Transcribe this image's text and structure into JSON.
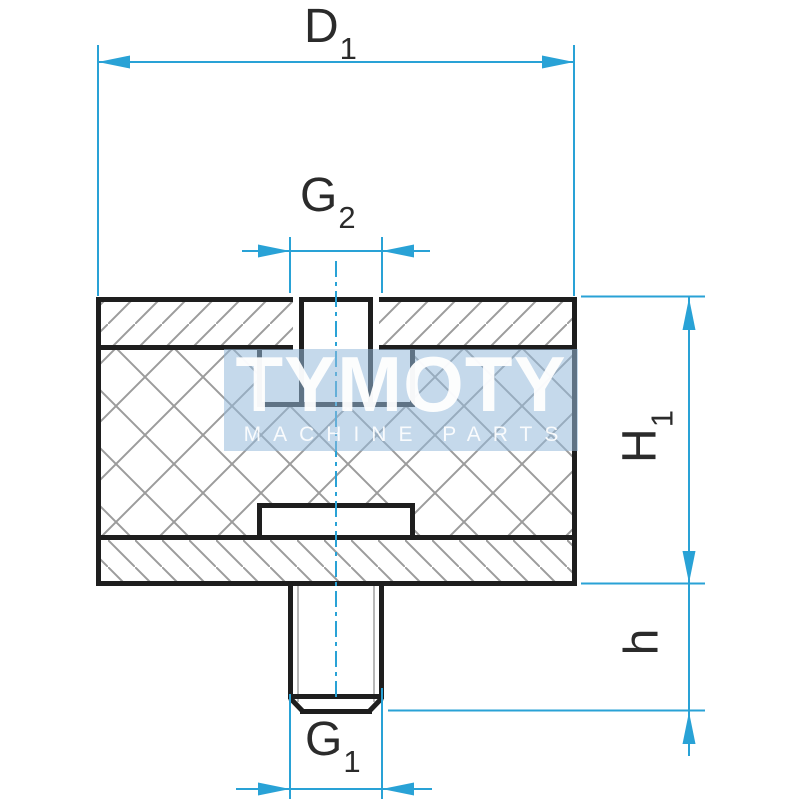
{
  "watermark": {
    "title": "TYMOTY",
    "subtitle": "MACHINE PARTS"
  },
  "dimensions": {
    "d1": {
      "base": "D",
      "sub": "1"
    },
    "g2": {
      "base": "G",
      "sub": "2"
    },
    "h1": {
      "base": "H",
      "sub": "1"
    },
    "h": {
      "base": "h",
      "sub": ""
    },
    "g1": {
      "base": "G",
      "sub": "1"
    }
  },
  "colors": {
    "dimension_line": "#29a2d6",
    "drawing_line": "#1e1e1e",
    "hatch_line": "#9c9c9c",
    "thread_line": "#b8b8b8",
    "watermark_bg": "rgba(150,186,219,0.55)",
    "watermark_text": "#ffffff",
    "background": "#ffffff"
  }
}
